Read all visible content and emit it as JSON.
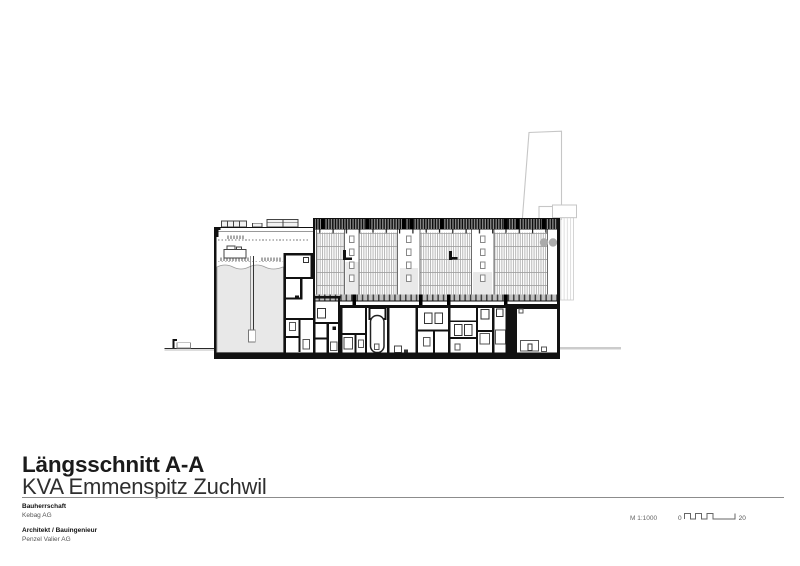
{
  "sheet": {
    "title": "Längsschnitt A-A",
    "subtitle": "KVA Emmenspitz Zuchwil",
    "info_blocks": [
      {
        "label": "Bauherrschaft",
        "value": "Kebag AG"
      },
      {
        "label": "Architekt / Bauingenieur",
        "value": "Penzel Valier AG"
      }
    ],
    "scale": {
      "text": "M 1:1000",
      "bar_start": "0",
      "bar_end": "20"
    }
  },
  "colors": {
    "paper": "#ffffff",
    "ink": "#111111",
    "rule_gray": "#8c8c8c",
    "bunker_fill": "#e8e8e8",
    "background_outline": "#c6c6c6",
    "facade_stripe": "#b3b3b3",
    "text_secondary": "#555555"
  }
}
